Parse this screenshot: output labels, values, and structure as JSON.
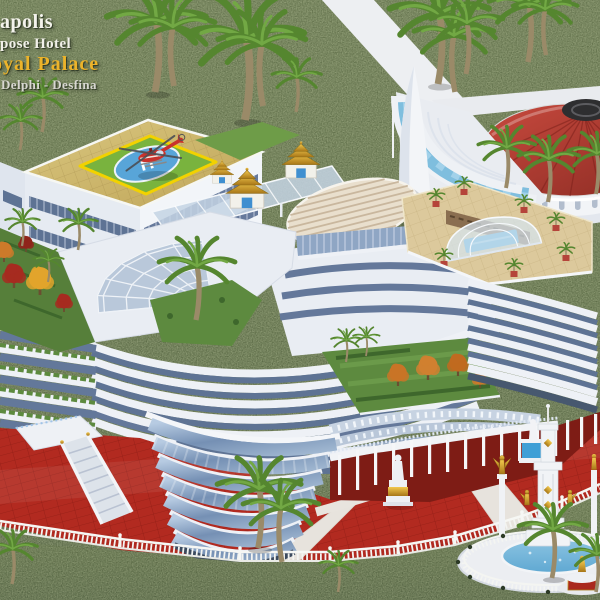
{
  "caption": {
    "line1": "apolis",
    "line2": "pose Hotel",
    "line3": "oyal Palace",
    "line4": "Delphi - Desfina"
  },
  "helipad": {
    "marking": "H"
  },
  "palette": {
    "grass": "#57663f",
    "grass_dark": "#475539",
    "caption_white": "#f4f3ec",
    "caption_gold": "#ecb32a",
    "building_white": "#eef1f6",
    "glass_blue": "#8ea8c9",
    "window_band": "#5e7394",
    "roof_tan": "#cfb96e",
    "helipad_green": "#79b33e",
    "helipad_border_yellow": "#f2d200",
    "helipad_circle_blue": "#58a5d8",
    "helicopter_red": "#c8322c",
    "rotunda_roof_red": "#b23a31",
    "pool_blue": "#7fbede",
    "plaza_red": "#b22a20",
    "gold": "#d4a437",
    "palm_green": "#55862f",
    "autumn_red": "#a62b20",
    "autumn_orange": "#cd7a2a",
    "autumn_yellow": "#e2a42c"
  },
  "scene": {
    "landmarks": [
      "hotel-rendering",
      "helipad-with-helicopter",
      "red-roof-rotunda",
      "crescent-pool",
      "golden-pagoda-spires",
      "elliptical-ribbed-roof",
      "glass-fan-skylight",
      "rooftop-pool-pavilion",
      "curved-glass-tower",
      "red-plaza",
      "fountain-tower",
      "statues",
      "palm-trees",
      "autumn-trees",
      "balustrade-fence",
      "grand-staircase",
      "white-walkways"
    ]
  }
}
